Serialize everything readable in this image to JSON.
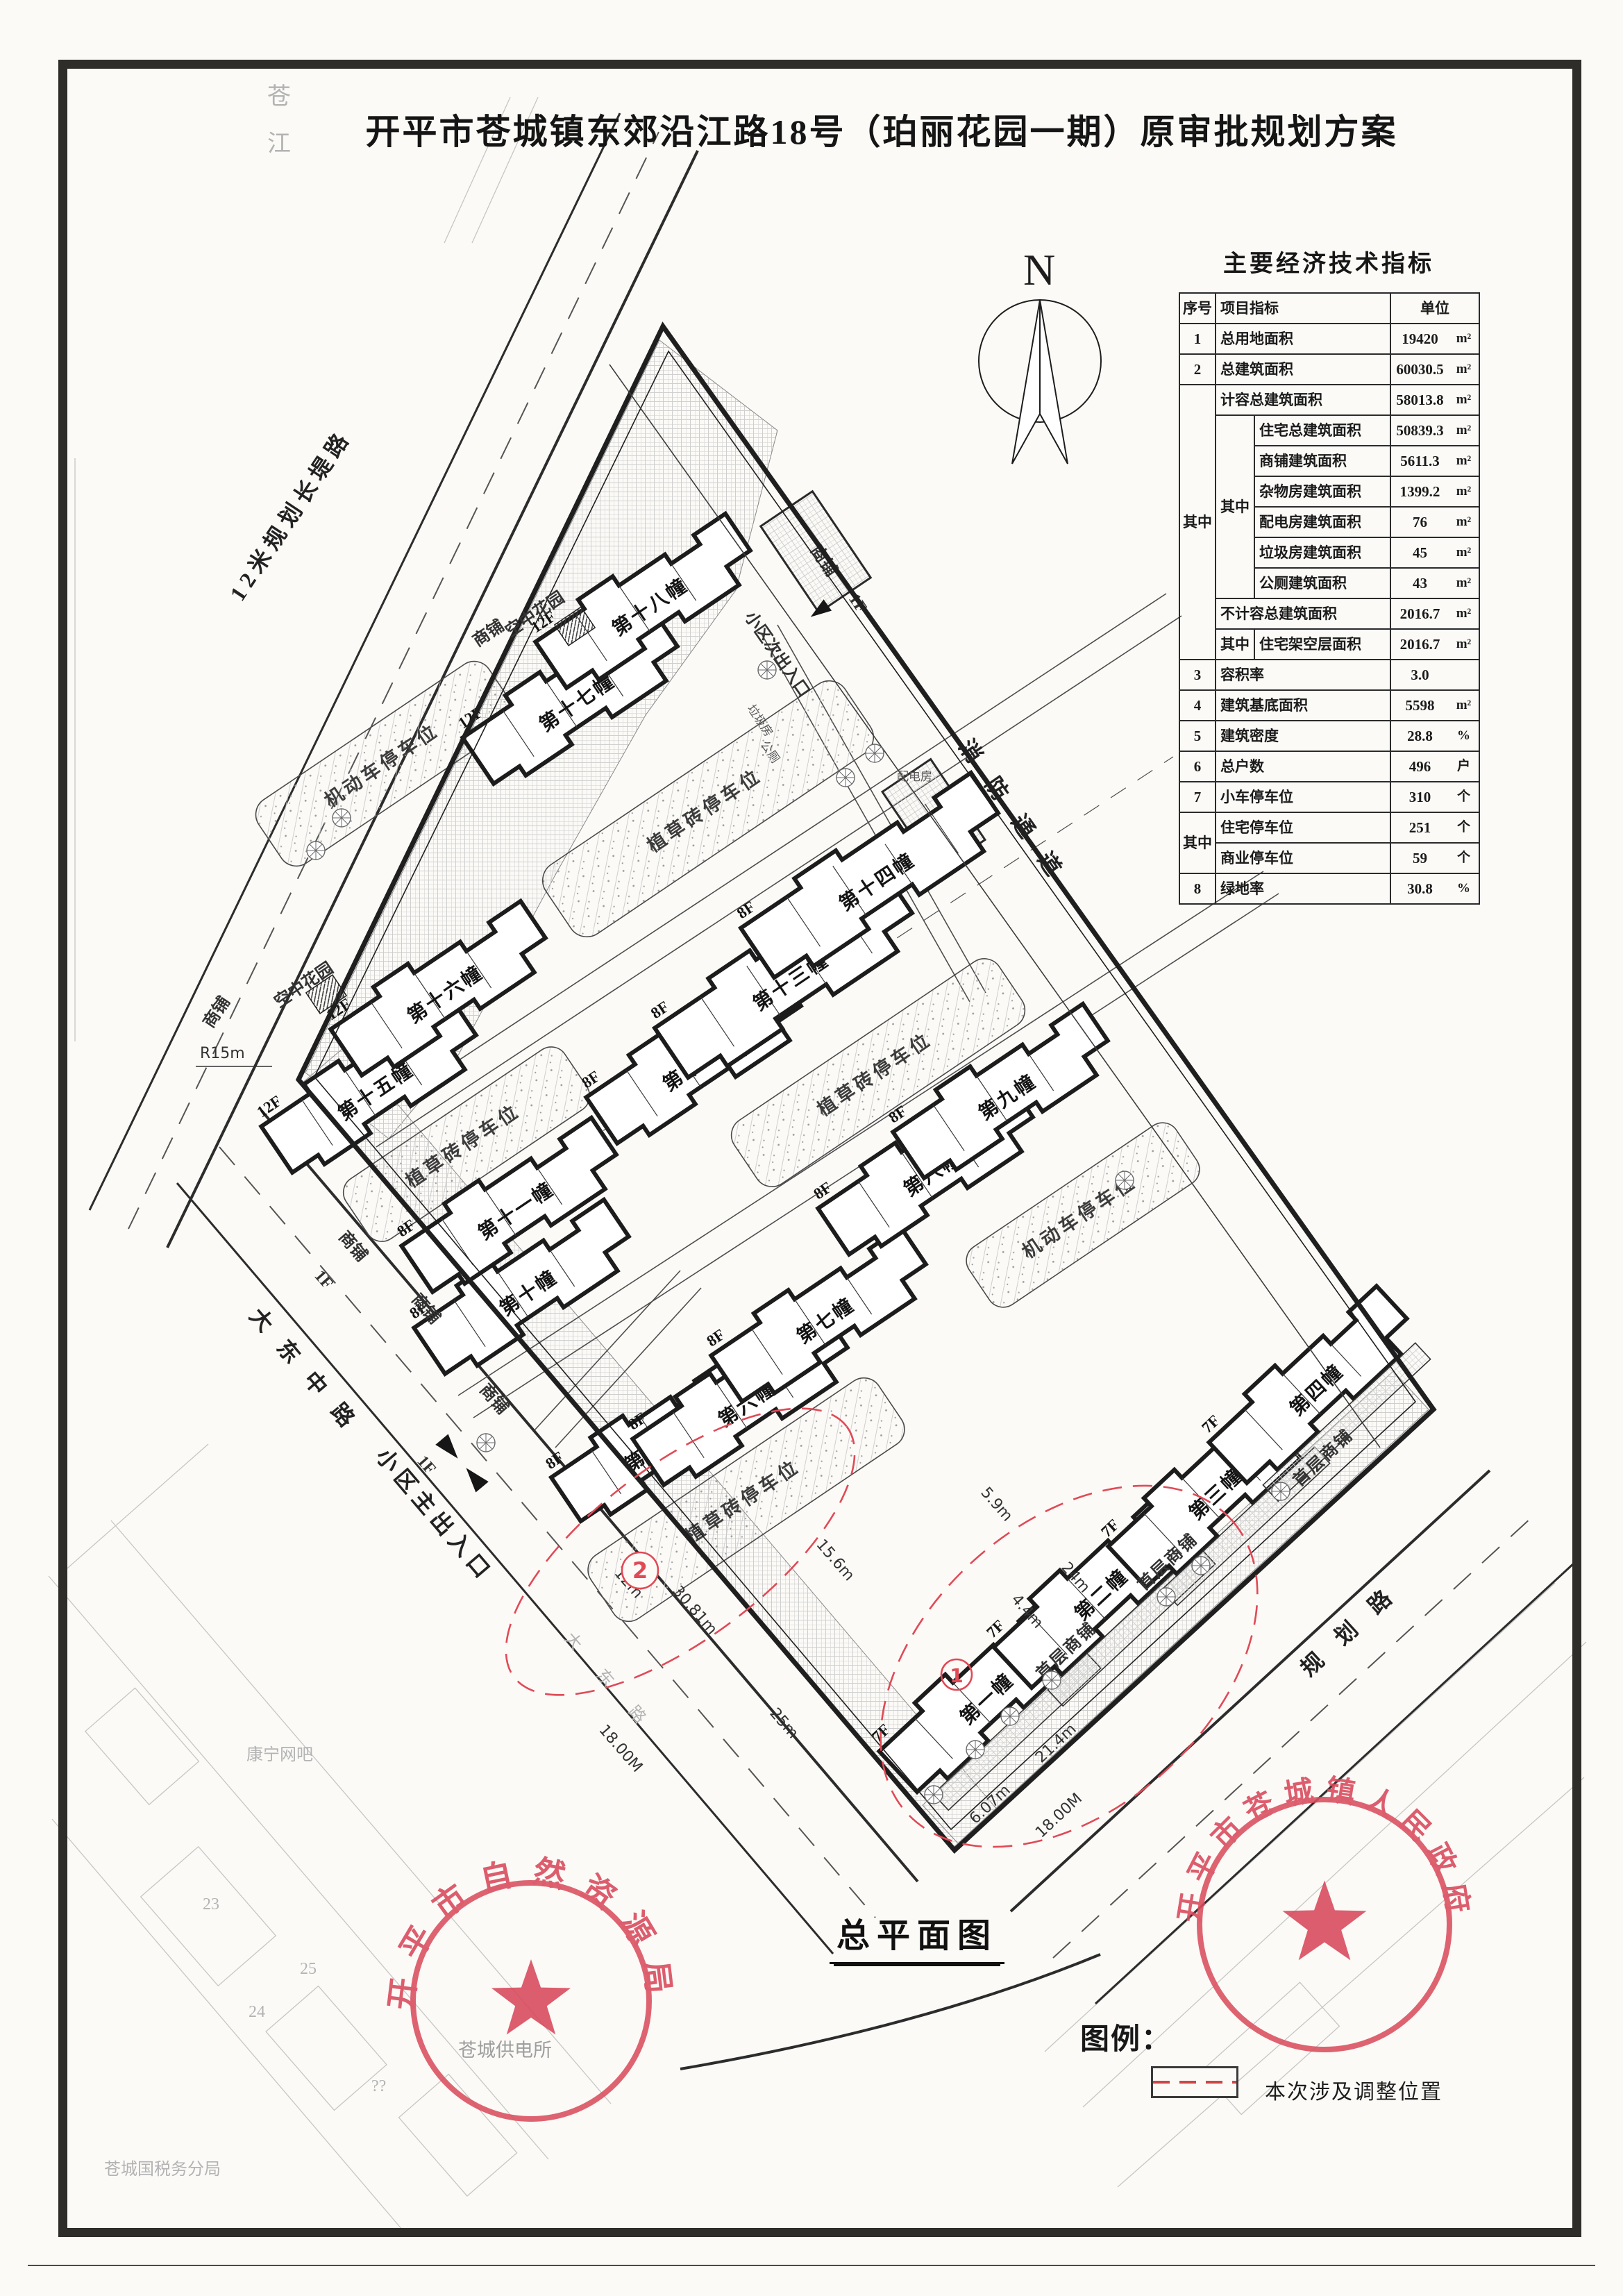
{
  "page": {
    "title": "开平市苍城镇东郊沿江路18号（珀丽花园一期）原审批规划方案",
    "drawing_label": "总平面图"
  },
  "compass": {
    "north": "N"
  },
  "indicators": {
    "title": "主要经济技术指标",
    "header": {
      "no": "序号",
      "item": "项目指标",
      "unit": "单位"
    },
    "zhong": "其中",
    "rows": {
      "r1": {
        "no": "1",
        "item": "总用地面积",
        "value": "19420",
        "unit": "m²"
      },
      "r2": {
        "no": "2",
        "item": "总建筑面积",
        "value": "60030.5",
        "unit": "m²"
      },
      "r3": {
        "item": "计容总建筑面积",
        "value": "58013.8",
        "unit": "m²"
      },
      "r4": {
        "item": "住宅总建筑面积",
        "value": "50839.3",
        "unit": "m²"
      },
      "r5": {
        "item": "商铺建筑面积",
        "value": "5611.3",
        "unit": "m²"
      },
      "r6": {
        "item": "杂物房建筑面积",
        "value": "1399.2",
        "unit": "m²"
      },
      "r7": {
        "item": "配电房建筑面积",
        "value": "76",
        "unit": "m²"
      },
      "r8": {
        "item": "垃圾房建筑面积",
        "value": "45",
        "unit": "m²"
      },
      "r9": {
        "item": "公厕建筑面积",
        "value": "43",
        "unit": "m²"
      },
      "r10": {
        "item": "不计容总建筑面积",
        "value": "2016.7",
        "unit": "m²"
      },
      "r11": {
        "item": "住宅架空层面积",
        "value": "2016.7",
        "unit": "m²"
      },
      "r12": {
        "no": "3",
        "item": "容积率",
        "value": "3.0",
        "unit": ""
      },
      "r13": {
        "no": "4",
        "item": "建筑基底面积",
        "value": "5598",
        "unit": "m²"
      },
      "r14": {
        "no": "5",
        "item": "建筑密度",
        "value": "28.8",
        "unit": "%"
      },
      "r15": {
        "no": "6",
        "item": "总户数",
        "value": "496",
        "unit": "户"
      },
      "r16": {
        "no": "7",
        "item": "小车停车位",
        "value": "310",
        "unit": "个"
      },
      "r17": {
        "item": "住宅停车位",
        "value": "251",
        "unit": "个"
      },
      "r18": {
        "item": "商业停车位",
        "value": "59",
        "unit": "个"
      },
      "r19": {
        "no": "8",
        "item": "绿地率",
        "value": "30.8",
        "unit": "%"
      }
    }
  },
  "plan": {
    "roads": {
      "changdi": "12米规划长堤路",
      "dadong": "大东中路",
      "main_gate": "小区主出入口",
      "planned": "规划路",
      "fire_lane": "消防通道",
      "side_gate": "小区次出入口",
      "dadong_short": "大东路"
    },
    "labels": {
      "grass_parking": "植草砖停车位",
      "motor_parking": "机动车停车位",
      "shop": "商铺",
      "ground_shop": "首层商铺",
      "sky_garden": "空中花园",
      "trash_room": "垃圾房",
      "toilet": "公厕",
      "power_room": "配电房",
      "f1": "1F"
    },
    "dims": {
      "road18": "18.00M",
      "d25": "25m",
      "d3081": "30.81m",
      "d12": "12m",
      "d156": "15.6m",
      "d214": "21.4m",
      "d607": "6.07m",
      "d44": "4.4m",
      "d24": "24m",
      "d59": "5.9m",
      "r15": "R15m"
    },
    "marks": {
      "n1": "1",
      "n2": "2"
    },
    "buildings": [
      {
        "name": "第一幢",
        "floors": "7F"
      },
      {
        "name": "第二幢",
        "floors": "7F"
      },
      {
        "name": "第三幢",
        "floors": "7F"
      },
      {
        "name": "第四幢",
        "floors": "7F"
      },
      {
        "name": "第五幢",
        "floors": "8F"
      },
      {
        "name": "第六幢",
        "floors": "8F"
      },
      {
        "name": "第七幢",
        "floors": "8F"
      },
      {
        "name": "第八幢",
        "floors": "8F"
      },
      {
        "name": "第九幢",
        "floors": "8F"
      },
      {
        "name": "第十幢",
        "floors": "8F"
      },
      {
        "name": "第十一幢",
        "floors": "8F"
      },
      {
        "name": "第十二幢",
        "floors": "8F"
      },
      {
        "name": "第十三幢",
        "floors": "8F"
      },
      {
        "name": "第十四幢",
        "floors": "8F"
      },
      {
        "name": "第十五幢",
        "floors": "12F"
      },
      {
        "name": "第十六幢",
        "floors": "12F"
      },
      {
        "name": "第十七幢",
        "floors": "12F"
      },
      {
        "name": "第十八幢",
        "floors": "12F"
      }
    ],
    "context": {
      "river": "苍江",
      "net_bar": "康宁网吧",
      "power_station": "苍城供电所",
      "tax_office": "苍城国税务分局",
      "parcels": [
        "23",
        "24",
        "25",
        "??"
      ]
    }
  },
  "legend": {
    "title": "图例：",
    "adjust": "本次涉及调整位置"
  },
  "stamps": {
    "left": "开平市自然资源局",
    "right": "开平市苍城镇人民政府"
  }
}
